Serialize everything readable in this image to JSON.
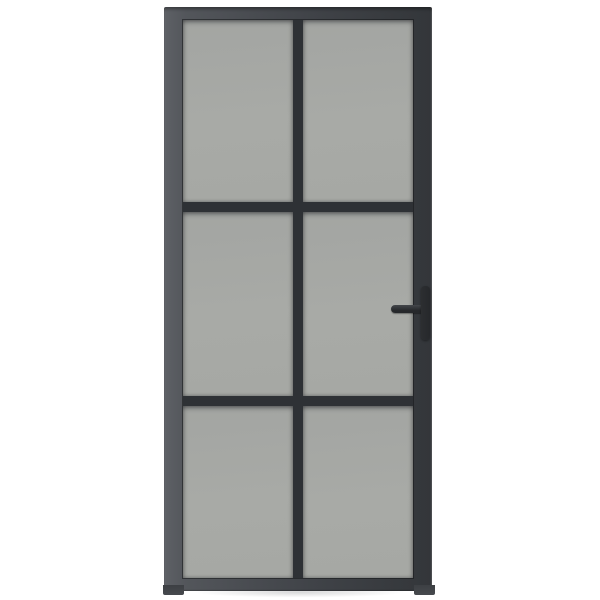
{
  "page": {
    "background_color": "#ffffff"
  },
  "door": {
    "label": "black-frame-glass-interior-door",
    "grid": {
      "columns": 2,
      "rows": 3,
      "panel_count": 6
    },
    "colors": {
      "frame": "#3f4247",
      "frame_highlight": "#5e6166",
      "frame_shadow": "#33363a",
      "divider": "#2e3135",
      "glass": "#a8aaa6",
      "handle": "#26282b"
    },
    "panels": [
      {
        "label": "glass-panel-top-left"
      },
      {
        "label": "glass-panel-top-right"
      },
      {
        "label": "glass-panel-middle-left"
      },
      {
        "label": "glass-panel-middle-right"
      },
      {
        "label": "glass-panel-bottom-left"
      },
      {
        "label": "glass-panel-bottom-right"
      }
    ],
    "handle": {
      "label": "lever-door-handle",
      "side": "right",
      "lever_label": "handle-lever",
      "plate_label": "handle-backplate"
    },
    "feet": {
      "left_label": "door-foot-left",
      "right_label": "door-foot-right"
    }
  }
}
